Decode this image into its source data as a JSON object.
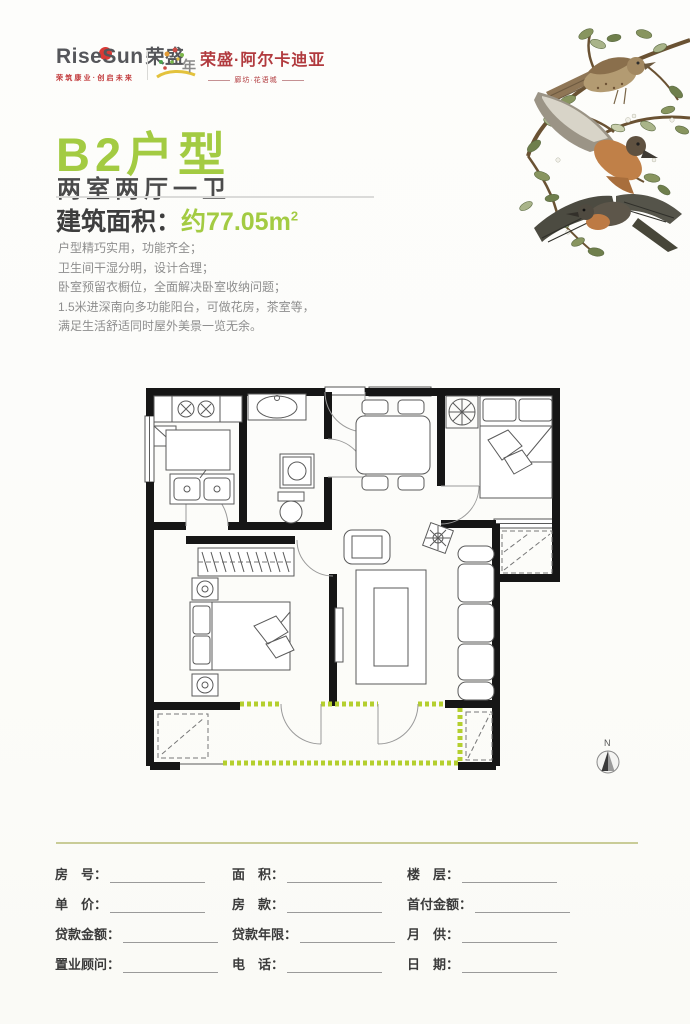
{
  "header": {
    "brand": {
      "name_latin": "RiseSun",
      "name_cn": "荣盛",
      "slogan": "荣筑康业·创启未来"
    },
    "anniversary": {
      "label": "年"
    },
    "project": {
      "name": "荣盛·阿尔卡迪亚",
      "subtitle": "廊坊·花语城"
    }
  },
  "listing": {
    "unit_title": "B2户型",
    "layout": "两室两厅一卫",
    "area_label": "建筑面积：",
    "area_value": "约77.05m",
    "area_sup": "2",
    "features": [
      "户型精巧实用，功能齐全；",
      "卫生间干湿分明，设计合理；",
      "卧室预留衣橱位，全面解决卧室收纳问题；",
      "1.5米进深南向多功能阳台，可做花房，茶室等，",
      "满足生活舒适同时屋外美景一览无余。"
    ]
  },
  "floorplan": {
    "compass_label": "N"
  },
  "colors": {
    "accent_green": "#a3cb42",
    "brand_red": "#b13a3e",
    "balcony_green": "#b4cf2e",
    "divider_olive": "#c9cc97"
  },
  "form": {
    "columns": [
      {
        "fields": [
          "房　号：",
          "单　价：",
          "贷款金额：",
          "置业顾问："
        ]
      },
      {
        "fields": [
          "面　积：",
          "房　款：",
          "贷款年限：",
          "电　话："
        ]
      },
      {
        "fields": [
          "楼　层：",
          "首付金额：",
          "月　供：",
          "日　期："
        ]
      }
    ]
  }
}
